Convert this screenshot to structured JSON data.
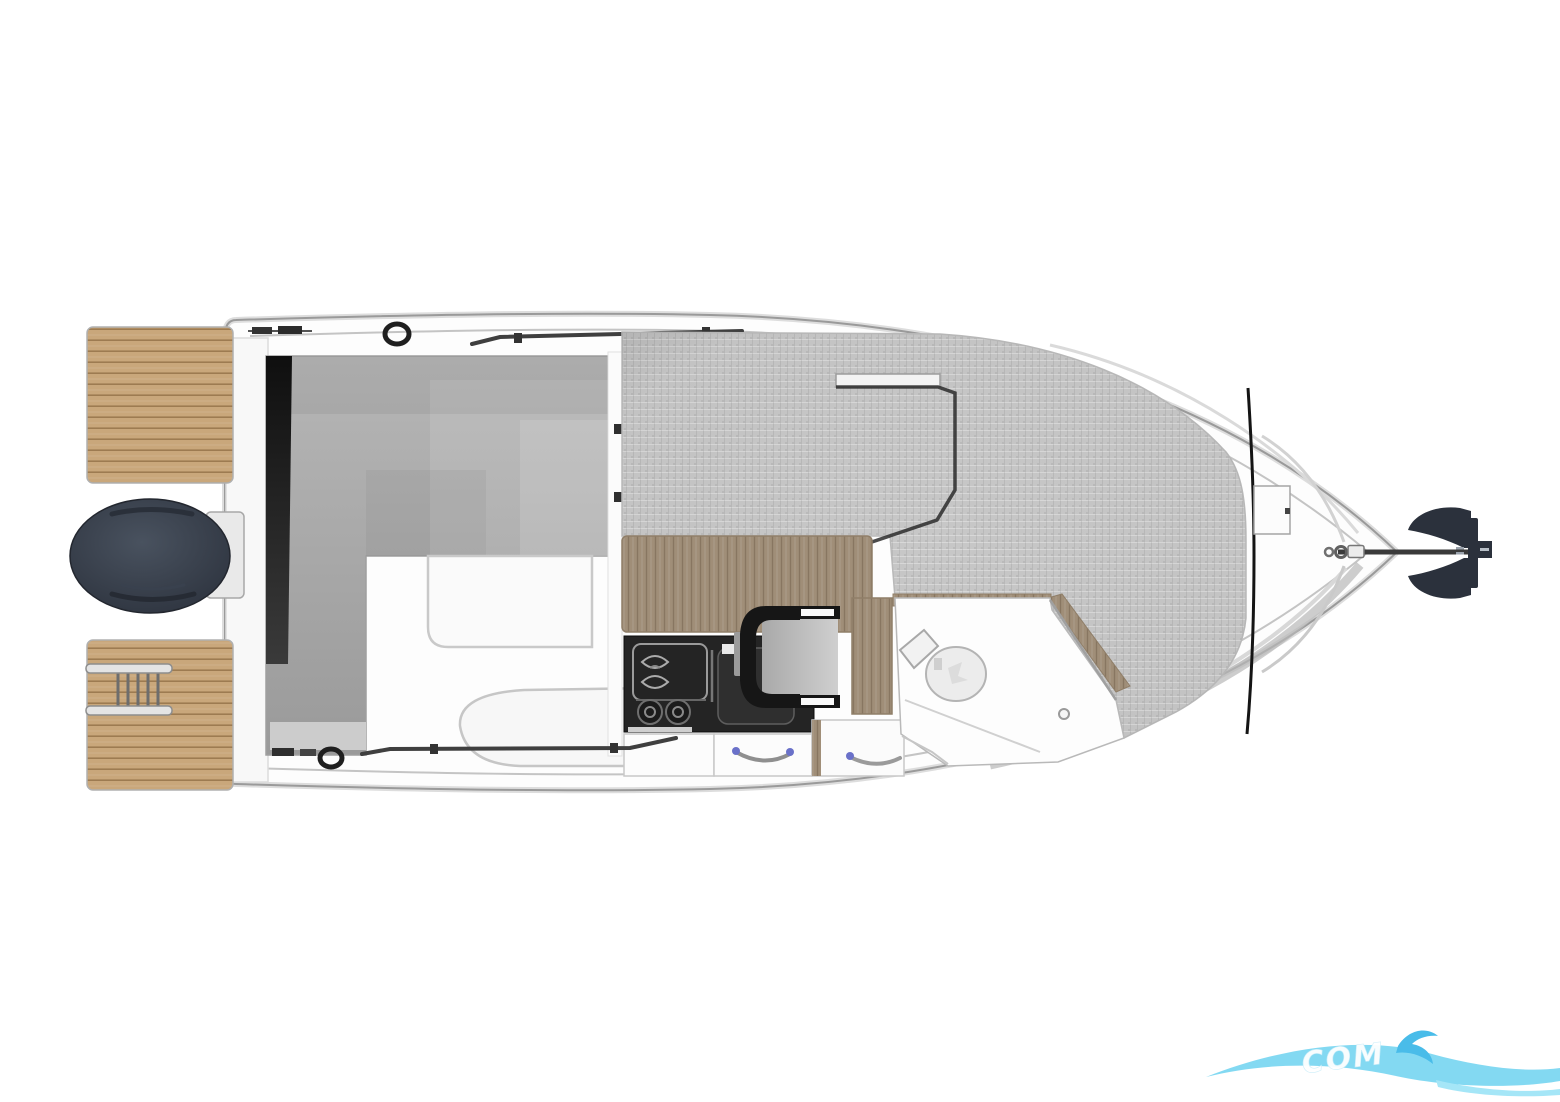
{
  "diagram": {
    "type": "boat-deck-plan",
    "orientation": "bow-right",
    "areas": [
      {
        "id": "swim-platform-port",
        "label": "Teak swim platform (port)"
      },
      {
        "id": "swim-platform-starboard",
        "label": "Teak swim platform (starboard)"
      },
      {
        "id": "boarding-ladder",
        "label": "Boarding ladder"
      },
      {
        "id": "outboard-engine",
        "label": "Outboard engine"
      },
      {
        "id": "transom-walkway",
        "label": "Transom walkway"
      },
      {
        "id": "cockpit-settee",
        "label": "L-shaped cockpit settee"
      },
      {
        "id": "cockpit-floor",
        "label": "Cockpit floor"
      },
      {
        "id": "cabin-berth-cushions",
        "label": "Cabin berth cushions"
      },
      {
        "id": "galley-counter",
        "label": "Galley worktop"
      },
      {
        "id": "galley-sink",
        "label": "Sink"
      },
      {
        "id": "galley-burners",
        "label": "Two-burner stove"
      },
      {
        "id": "helm-seat",
        "label": "Helm seat"
      },
      {
        "id": "storage-drawers",
        "label": "Storage drawers"
      },
      {
        "id": "head-compartment",
        "label": "Head compartment"
      },
      {
        "id": "toilet",
        "label": "Marine toilet"
      },
      {
        "id": "bow-deck",
        "label": "Bow deck"
      },
      {
        "id": "anchor-locker",
        "label": "Windlass / anchor locker"
      },
      {
        "id": "anchor",
        "label": "Anchor"
      },
      {
        "id": "deck-fittings",
        "label": "Cleats, rings and grab rails"
      }
    ],
    "colors": {
      "hull_line": "#9a9a9a",
      "hull_soft": "#dddddd",
      "teak": "#c9a77b",
      "teak_line": "#8d6b42",
      "wood": "#a08e78",
      "cushion": "#c7c7c7",
      "bench_light": "#b6b6b6",
      "bench_dark": "#9a9a9a",
      "engine_light": "#49525f",
      "engine_dark": "#2c323d",
      "galley_dark": "#242424",
      "seat_frame": "#161616",
      "seat_cushion": "#bdbdbd",
      "anchor": "#2b313c",
      "handle_accent": "#6a71c9"
    },
    "watermark": {
      "text": "COM",
      "wave_color": "#7cd7f1",
      "tail_color": "#a5e6f7",
      "accent_color": "#49bce9",
      "text_color": "#ffffff"
    }
  }
}
